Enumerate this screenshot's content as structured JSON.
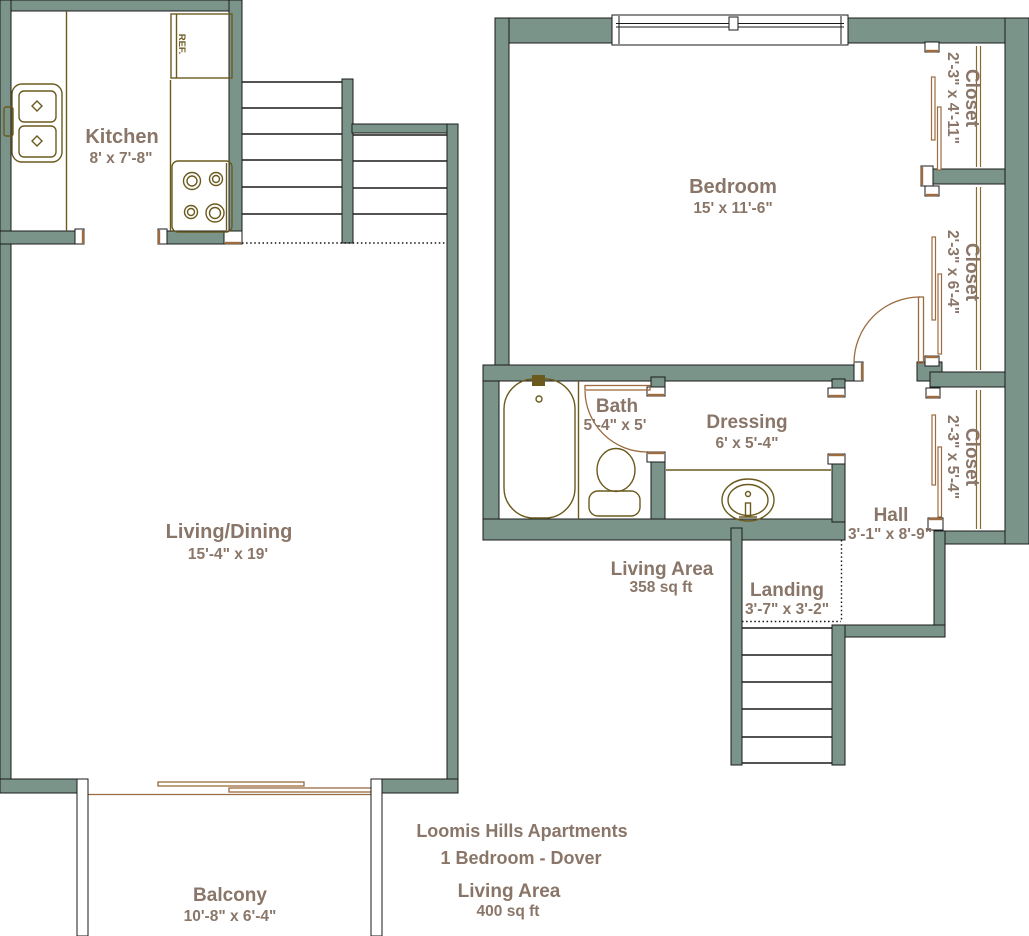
{
  "title": {
    "line1": "Loomis Hills Apartments",
    "line2": "1 Bedroom - Dover",
    "area_label": "Living Area",
    "area_value": "400 sq ft"
  },
  "upper_area": {
    "label": "Living Area",
    "value": "358 sq ft"
  },
  "rooms": {
    "kitchen": {
      "name": "Kitchen",
      "dims": "8' x 7'-8\""
    },
    "living_dining": {
      "name": "Living/Dining",
      "dims": "15'-4\" x 19'"
    },
    "bedroom": {
      "name": "Bedroom",
      "dims": "15' x 11'-6\""
    },
    "bath": {
      "name": "Bath",
      "dims": "5'-4\" x 5'"
    },
    "dressing": {
      "name": "Dressing",
      "dims": "6' x 5'-4\""
    },
    "hall": {
      "name": "Hall",
      "dims": "3'-1\" x 8'-9\""
    },
    "landing": {
      "name": "Landing",
      "dims": "3'-7\" x 3'-2\""
    },
    "balcony": {
      "name": "Balcony",
      "dims": "10'-8\" x 6'-4\""
    },
    "closet_top": {
      "name": "Closet",
      "dims": "2'-3\" x 4'-11\""
    },
    "closet_middle": {
      "name": "Closet",
      "dims": "2'-3\" x 6'-4\""
    },
    "closet_bottom": {
      "name": "Closet",
      "dims": "2'-3\" x 5'-4\""
    }
  },
  "appliances": {
    "refrigerator": "REF."
  },
  "colors": {
    "wall": "#7a948a",
    "fixture": "#6b5a1e",
    "door": "#9c6b3f",
    "text": "#8a7668"
  }
}
